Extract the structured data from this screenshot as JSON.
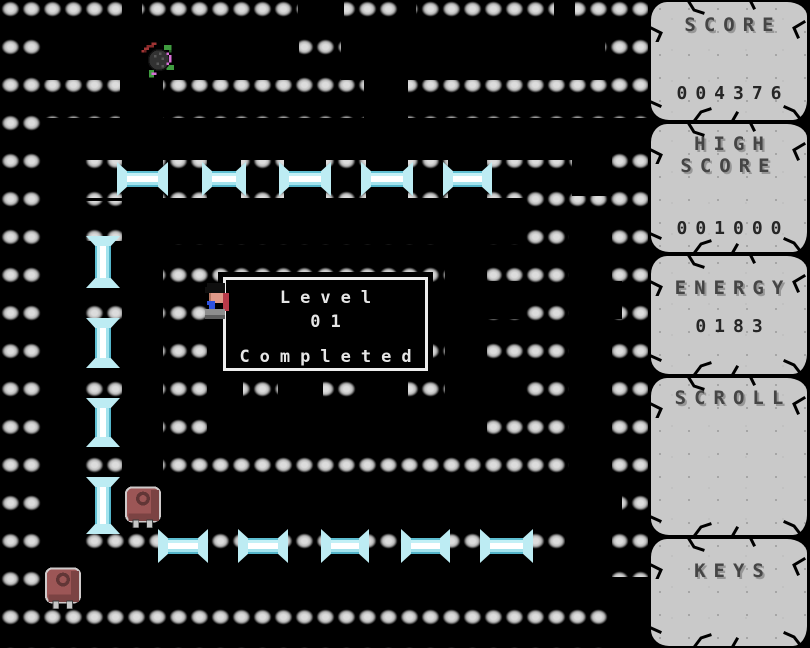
{
  "game_title": "maze dungeon level screen",
  "message_box": {
    "x": 218,
    "y": 272,
    "w": 215,
    "h": 104,
    "lines": [
      "Level",
      "01",
      "Completed"
    ]
  },
  "hud": {
    "panels": [
      {
        "id": "score",
        "title": "SCORE",
        "value": "004376"
      },
      {
        "id": "high-score",
        "title": "HIGH\nSCORE",
        "value": "001000"
      },
      {
        "id": "energy",
        "title": "ENERGY",
        "value": "0183"
      },
      {
        "id": "scroll",
        "title": "SCROLL",
        "value": ""
      },
      {
        "id": "keys",
        "title": "KEYS",
        "value": ""
      }
    ]
  },
  "colors": {
    "background": "#000000",
    "stone_light": "#dcdcdc",
    "stone_mid": "#c0c0c0",
    "stone_shadow": "#4d4d4d",
    "ice_edge": "#5fbfd2",
    "ice_core": "#ffffff",
    "tablet": "#c9c9c9",
    "hud_text": "#454545",
    "hud_value": "#262626",
    "dialog_text": "#e6e6e6",
    "tower_red": "#9c5656",
    "enemy_green": "#3f9b3f",
    "enemy_magenta": "#d76fd7",
    "player_blue": "#2e52e0"
  },
  "maze": {
    "walls": [
      [
        0,
        0,
        648,
        38
      ],
      [
        0,
        0,
        42,
        648
      ],
      [
        0,
        606,
        608,
        42
      ],
      [
        605,
        0,
        43,
        118
      ],
      [
        612,
        137,
        36,
        440
      ],
      [
        299,
        38,
        42,
        42
      ],
      [
        42,
        80,
        78,
        38
      ],
      [
        163,
        80,
        201,
        38
      ],
      [
        408,
        80,
        240,
        38
      ],
      [
        83,
        160,
        39,
        38
      ],
      [
        163,
        160,
        44,
        38
      ],
      [
        241,
        160,
        43,
        38
      ],
      [
        326,
        160,
        40,
        38
      ],
      [
        408,
        160,
        40,
        38
      ],
      [
        487,
        160,
        85,
        38
      ],
      [
        528,
        196,
        120,
        20
      ],
      [
        525,
        196,
        44,
        287
      ],
      [
        487,
        244,
        38,
        37
      ],
      [
        487,
        319,
        38,
        40
      ],
      [
        487,
        401,
        38,
        44
      ],
      [
        163,
        244,
        44,
        239
      ],
      [
        163,
        244,
        282,
        38
      ],
      [
        408,
        326,
        37,
        33
      ],
      [
        408,
        376,
        37,
        37
      ],
      [
        243,
        376,
        35,
        37
      ],
      [
        323,
        376,
        35,
        37
      ],
      [
        163,
        445,
        402,
        38
      ],
      [
        83,
        201,
        39,
        40
      ],
      [
        83,
        283,
        39,
        40
      ],
      [
        83,
        363,
        39,
        40
      ],
      [
        83,
        442,
        39,
        40
      ],
      [
        83,
        529,
        80,
        36
      ],
      [
        203,
        527,
        40,
        38
      ],
      [
        283,
        527,
        43,
        38
      ],
      [
        364,
        527,
        42,
        38
      ],
      [
        445,
        527,
        40,
        38
      ],
      [
        528,
        527,
        37,
        38
      ]
    ],
    "cutouts": [
      [
        122,
        0,
        20,
        18
      ],
      [
        298,
        0,
        46,
        18
      ],
      [
        399,
        0,
        17,
        18
      ],
      [
        554,
        0,
        21,
        18
      ],
      [
        612,
        281,
        10,
        38
      ],
      [
        612,
        488,
        10,
        37
      ]
    ],
    "beams_h": [
      [
        120,
        171,
        45
      ],
      [
        205,
        171,
        38
      ],
      [
        282,
        171,
        46
      ],
      [
        364,
        171,
        46
      ],
      [
        446,
        171,
        43
      ],
      [
        161,
        538,
        44
      ],
      [
        241,
        538,
        44
      ],
      [
        324,
        538,
        42
      ],
      [
        404,
        538,
        43
      ],
      [
        483,
        538,
        47
      ]
    ],
    "beams_v": [
      [
        95,
        239,
        46
      ],
      [
        95,
        321,
        44
      ],
      [
        95,
        401,
        43
      ],
      [
        95,
        480,
        51
      ]
    ]
  },
  "sprites": {
    "enemy": {
      "x": 139,
      "y": 40,
      "w": 40,
      "h": 40
    },
    "player": {
      "x": 203,
      "y": 283,
      "w": 26,
      "h": 40
    },
    "tower_a": {
      "x": 122,
      "y": 486,
      "w": 42,
      "h": 42
    },
    "tower_b": {
      "x": 42,
      "y": 567,
      "w": 42,
      "h": 42
    }
  }
}
